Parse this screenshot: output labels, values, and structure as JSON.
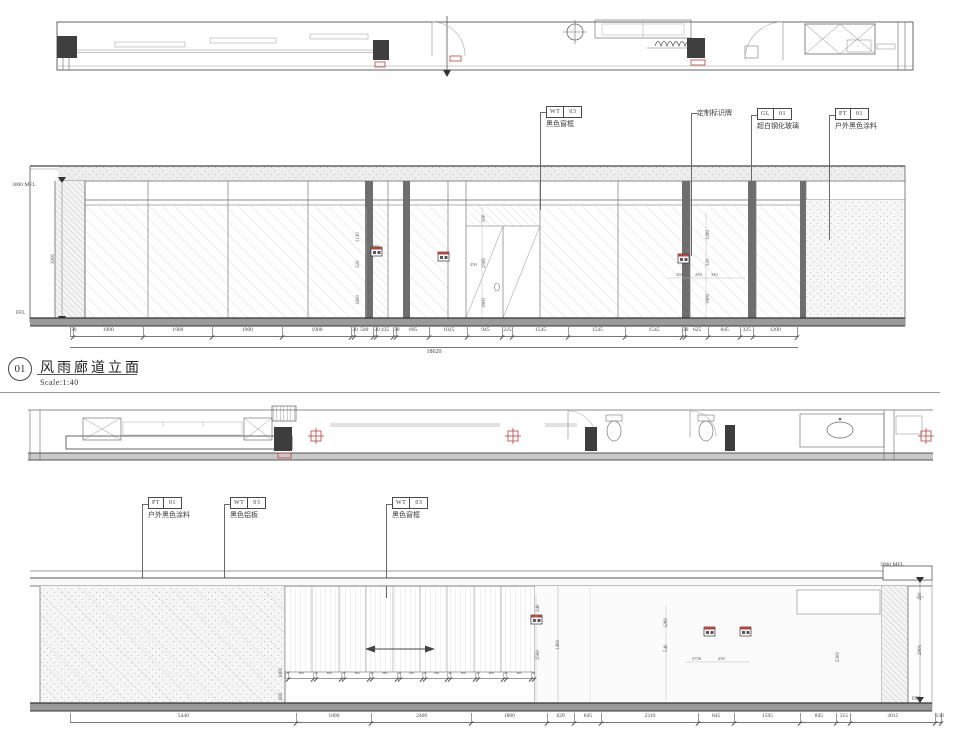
{
  "colors": {
    "red": "#b4453e",
    "line": "#4a4a4a",
    "floor": "#9a9a9a"
  },
  "sheet1": {
    "callouts": [
      {
        "tag": "WT",
        "num": "03",
        "desc": "黑色窗框"
      },
      {
        "desc": "定制标识牌"
      },
      {
        "tag": "GL",
        "num": "01",
        "desc": "超白钢化玻璃"
      },
      {
        "tag": "PT",
        "num": "01",
        "desc": "户外黑色涂料"
      }
    ],
    "levels": {
      "top": "3000 MFL",
      "mid": "3000",
      "bottom": "FFL"
    },
    "dims_row": [
      "30",
      "1900",
      "1900",
      "1900",
      "1900",
      "30",
      "500",
      "30",
      "435",
      "30",
      "895",
      "1025",
      "945",
      "225",
      "1545",
      "1545",
      "1545",
      "30",
      "625",
      "845",
      "325",
      "1200"
    ],
    "dims_total": "18620",
    "inner_dims": [
      "1130",
      "320",
      "1600",
      "150",
      "500",
      "2560",
      "1600",
      "250",
      "1280",
      "320",
      "1600",
      "350",
      "250",
      "345"
    ],
    "title": {
      "number": "01",
      "name": "风雨廊道立面",
      "scale": "Scale:1:40"
    }
  },
  "sheet2": {
    "callouts": [
      {
        "tag": "PT",
        "num": "01",
        "desc": "户外黑色涂料"
      },
      {
        "tag": "WT",
        "num": "03",
        "desc": "黑色铝板"
      },
      {
        "tag": "WT",
        "num": "03",
        "desc": "黑色窗框"
      }
    ],
    "levels": {
      "top": "3000 MFL",
      "upper": "200",
      "lower": "2800",
      "bottom": "FFL"
    },
    "dims_row": [
      "5440",
      "1800",
      "2400",
      "1800",
      "629",
      "645",
      "2310",
      "845",
      "1595",
      "845",
      "315",
      "2015",
      "130"
    ],
    "louver_dims": [
      "30",
      "360",
      "20",
      "360",
      "20",
      "360",
      "20",
      "360",
      "20",
      "320",
      "20",
      "320",
      "20",
      "360",
      "20",
      "360",
      "20",
      "360",
      "30"
    ],
    "inner_dims": [
      "240",
      "2560",
      "1400",
      "1000",
      "600",
      "1280",
      "540",
      "2750",
      "250",
      "2300",
      "200",
      "2800"
    ]
  }
}
